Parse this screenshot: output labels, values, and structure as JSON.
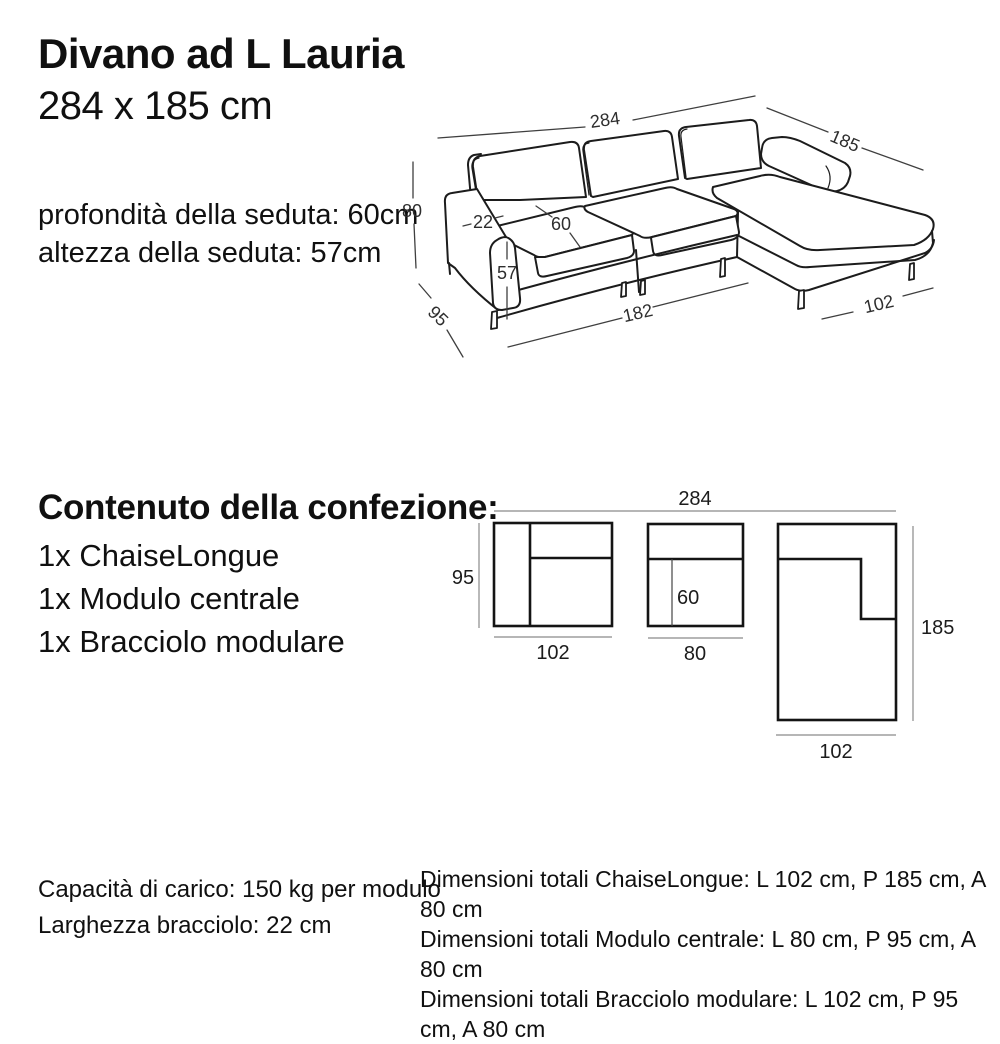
{
  "header": {
    "title": "Divano ad L Lauria",
    "subtitle": "284 x 185 cm"
  },
  "seat_info": {
    "line1": "profondità della seduta: 60cm",
    "line2": "altezza della seduta: 57cm"
  },
  "iso": {
    "total_width": "284",
    "total_depth": "185",
    "total_height": "80",
    "arm_width": "22",
    "seat_depth": "60",
    "seat_height": "57",
    "module_depth": "95",
    "seats_width": "182",
    "chaise_width": "102"
  },
  "package": {
    "heading": "Contenuto della confezione:",
    "items": [
      "1x ChaiseLongue",
      "1x Modulo centrale",
      "1x Bracciolo modulare"
    ]
  },
  "top_view": {
    "total_width": "284",
    "module_depth": "95",
    "bracciolo_width": "102",
    "seat_depth": "60",
    "centrale_width": "80",
    "chaise_depth": "185",
    "chaise_width": "102"
  },
  "specs": {
    "left": {
      "line1": "Capacità di carico: 150 kg per modulo",
      "line2": "Larghezza bracciolo: 22 cm"
    },
    "right": {
      "line1": "Dimensioni totali ChaiseLongue: L 102 cm, P 185 cm, A 80 cm",
      "line2": "Dimensioni totali Modulo centrale: L 80 cm, P 95 cm, A 80 cm",
      "line3": "Dimensioni totali Bracciolo modulare: L 102 cm, P 95 cm, A 80 cm"
    }
  }
}
